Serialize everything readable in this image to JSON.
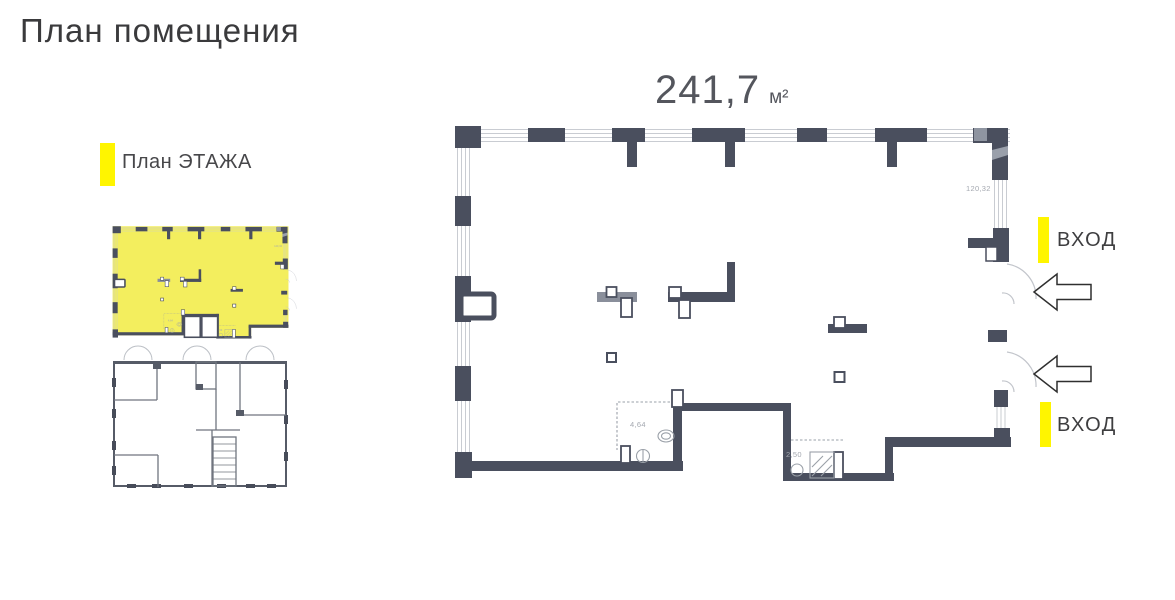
{
  "page": {
    "title": "План помещения"
  },
  "legend": {
    "label": "План ЭТАЖА",
    "marker_color": "#fff500"
  },
  "area": {
    "value": "241,7",
    "unit": "м²"
  },
  "entrances": [
    {
      "label": "ВХОД"
    },
    {
      "label": "ВХОД"
    }
  ],
  "dimensions": {
    "window_width": "120,32",
    "wc_area": "4,64",
    "shower_area": "2,50"
  },
  "colors": {
    "wall": "#4a4f5e",
    "window": "#c9ccd2",
    "thumbnail_highlight": "#f3ee5e",
    "marker_yellow": "#fff500"
  }
}
